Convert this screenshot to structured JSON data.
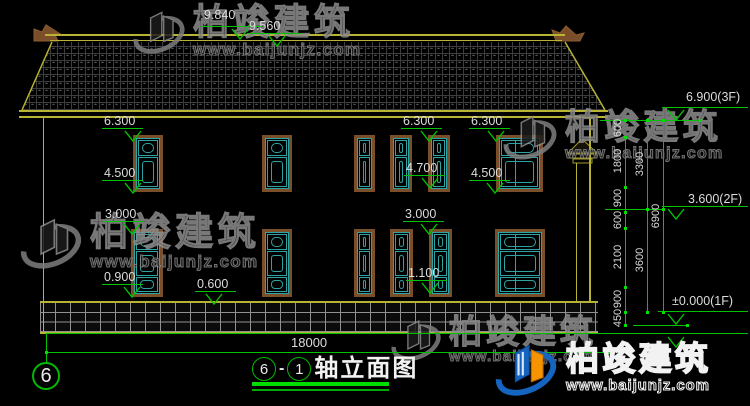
{
  "drawing": {
    "sheet_grid_bubble": "6",
    "title_axis_start": "6",
    "title_separator": "-",
    "title_axis_end": "1",
    "title_name": "轴立面图",
    "overall_width_dim": "18000"
  },
  "elevation_markers": [
    {
      "text": "9.840"
    },
    {
      "text": "9.560"
    },
    {
      "text": "6.300"
    },
    {
      "text": "4.500"
    },
    {
      "text": "6.300"
    },
    {
      "text": "6.300"
    },
    {
      "text": "4.700"
    },
    {
      "text": "4.500"
    },
    {
      "text": "3.000"
    },
    {
      "text": "0.900"
    },
    {
      "text": "0.600"
    },
    {
      "text": "3.000"
    },
    {
      "text": "1.100"
    },
    {
      "text": "6.900(3F)"
    },
    {
      "text": "3.600(2F)"
    },
    {
      "text": "±0.000(1F)"
    }
  ],
  "chain_dims": {
    "segments": [
      "600",
      "1800",
      "900",
      "600",
      "2100",
      "900",
      "450"
    ],
    "subtotals": [
      "3300",
      "3600"
    ],
    "total": "6900"
  },
  "watermarks": {
    "brand": "柏竣建筑",
    "url": "www.baijunjz.com"
  },
  "colors": {
    "background": "#000000",
    "cad_yellow": "#b8b332",
    "dim_green": "#00c400",
    "window_teal": "#2fa3a3",
    "frame_brown": "#7a4e28",
    "text_white": "#dcdcdc",
    "logo_blue": "#1565c0",
    "logo_orange": "#f59300"
  }
}
